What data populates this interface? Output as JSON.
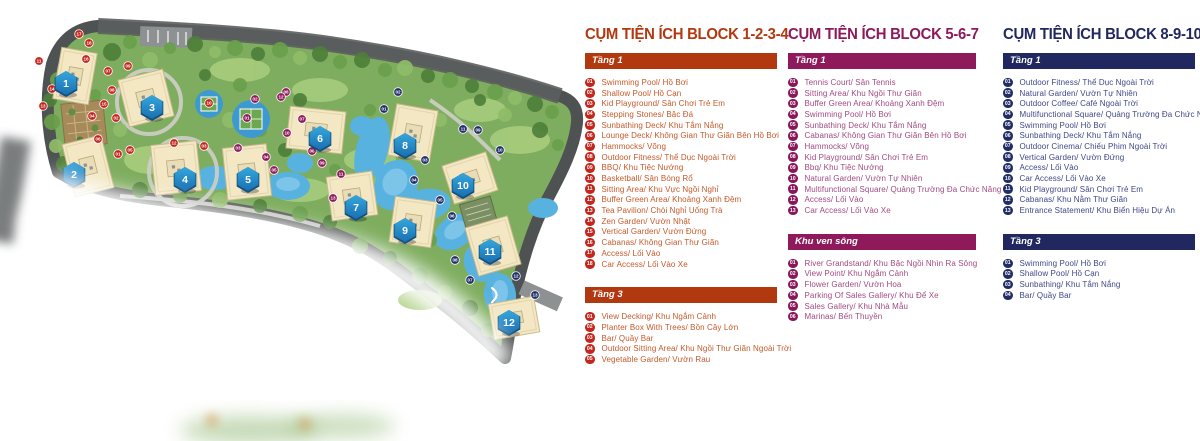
{
  "map": {
    "colors": {
      "site_green": "#7FAD5F",
      "tree_dark": "#4E7F3A",
      "tree_mid": "#69A04B",
      "tree_light": "#8FBC68",
      "lawn": "#A9CE7E",
      "road": "#4F5252",
      "path": "#CFCFC8",
      "water": "#58B2DF",
      "water_light": "#9AD4F0",
      "building": "#F3E7C4",
      "building_edge": "#C9B88C",
      "marker_blue_top": "#35A7DD",
      "marker_blue_bottom": "#1A6FB0",
      "marker_blue_edge": "#10507F"
    },
    "buildings": [
      {
        "num": "1",
        "marker": {
          "x": 66,
          "y": 84
        },
        "rect": {
          "cx": 75,
          "cy": 76,
          "w": 36,
          "h": 52,
          "rot": 10
        }
      },
      {
        "num": "2",
        "marker": {
          "x": 74,
          "y": 175
        },
        "rect": {
          "cx": 88,
          "cy": 166,
          "w": 40,
          "h": 54,
          "rot": -14
        }
      },
      {
        "num": "3",
        "marker": {
          "x": 152,
          "y": 108
        },
        "rect": {
          "cx": 146,
          "cy": 98,
          "w": 46,
          "h": 48,
          "rot": -14
        }
      },
      {
        "num": "4",
        "marker": {
          "x": 185,
          "y": 180
        },
        "rect": {
          "cx": 176,
          "cy": 168,
          "w": 46,
          "h": 50,
          "rot": -6
        }
      },
      {
        "num": "5",
        "marker": {
          "x": 248,
          "y": 180
        },
        "rect": {
          "cx": 247,
          "cy": 172,
          "w": 44,
          "h": 52,
          "rot": -6
        }
      },
      {
        "num": "6",
        "marker": {
          "x": 320,
          "y": 139
        },
        "rect": {
          "cx": 316,
          "cy": 130,
          "w": 56,
          "h": 42,
          "rot": 6
        }
      },
      {
        "num": "7",
        "marker": {
          "x": 356,
          "y": 208
        },
        "rect": {
          "cx": 352,
          "cy": 196,
          "w": 46,
          "h": 44,
          "rot": -8
        }
      },
      {
        "num": "8",
        "marker": {
          "x": 405,
          "y": 146
        },
        "rect": {
          "cx": 413,
          "cy": 133,
          "w": 42,
          "h": 52,
          "rot": 10
        }
      },
      {
        "num": "9",
        "marker": {
          "x": 405,
          "y": 231
        },
        "rect": {
          "cx": 413,
          "cy": 222,
          "w": 42,
          "h": 46,
          "rot": 8
        }
      },
      {
        "num": "10",
        "marker": {
          "x": 463,
          "y": 186
        },
        "rect": {
          "cx": 470,
          "cy": 178,
          "w": 46,
          "h": 40,
          "rot": -18
        }
      },
      {
        "num": "11",
        "marker": {
          "x": 490,
          "y": 252
        },
        "rect": {
          "cx": 493,
          "cy": 246,
          "w": 44,
          "h": 50,
          "rot": -16
        }
      },
      {
        "num": "12",
        "marker": {
          "x": 509,
          "y": 323
        },
        "rect": {
          "cx": 514,
          "cy": 318,
          "w": 46,
          "h": 36,
          "rot": -10
        }
      }
    ],
    "amenity_dots": [
      {
        "group": "red",
        "color": "#C2261C",
        "dots": [
          {
            "n": "01",
            "x": 118,
            "y": 154
          },
          {
            "n": "02",
            "x": 116,
            "y": 118
          },
          {
            "n": "03",
            "x": 204,
            "y": 146
          },
          {
            "n": "04",
            "x": 92,
            "y": 116
          },
          {
            "n": "05",
            "x": 130,
            "y": 150
          },
          {
            "n": "06",
            "x": 98,
            "y": 139
          },
          {
            "n": "07",
            "x": 108,
            "y": 71
          },
          {
            "n": "08",
            "x": 112,
            "y": 90
          },
          {
            "n": "09",
            "x": 128,
            "y": 66
          },
          {
            "n": "10",
            "x": 209,
            "y": 103
          },
          {
            "n": "11",
            "x": 39,
            "y": 61
          },
          {
            "n": "12",
            "x": 174,
            "y": 143
          },
          {
            "n": "13",
            "x": 43,
            "y": 106
          },
          {
            "n": "14",
            "x": 52,
            "y": 89
          },
          {
            "n": "15",
            "x": 104,
            "y": 104
          },
          {
            "n": "16",
            "x": 86,
            "y": 59
          },
          {
            "n": "17",
            "x": 79,
            "y": 34
          },
          {
            "n": "18",
            "x": 89,
            "y": 43
          }
        ]
      },
      {
        "group": "purple",
        "color": "#8E1A5B",
        "dots": [
          {
            "n": "01",
            "x": 247,
            "y": 118
          },
          {
            "n": "02",
            "x": 255,
            "y": 99
          },
          {
            "n": "03",
            "x": 238,
            "y": 148
          },
          {
            "n": "04",
            "x": 266,
            "y": 157
          },
          {
            "n": "05",
            "x": 274,
            "y": 170
          },
          {
            "n": "06",
            "x": 286,
            "y": 92
          },
          {
            "n": "07",
            "x": 302,
            "y": 119
          },
          {
            "n": "08",
            "x": 312,
            "y": 151
          },
          {
            "n": "09",
            "x": 322,
            "y": 163
          },
          {
            "n": "10",
            "x": 287,
            "y": 133
          },
          {
            "n": "11",
            "x": 341,
            "y": 174
          },
          {
            "n": "12",
            "x": 281,
            "y": 97
          },
          {
            "n": "13",
            "x": 333,
            "y": 198
          }
        ]
      },
      {
        "group": "navy",
        "color": "#202D66",
        "dots": [
          {
            "n": "01",
            "x": 384,
            "y": 109
          },
          {
            "n": "02",
            "x": 398,
            "y": 92
          },
          {
            "n": "03",
            "x": 425,
            "y": 160
          },
          {
            "n": "04",
            "x": 414,
            "y": 180
          },
          {
            "n": "05",
            "x": 440,
            "y": 200
          },
          {
            "n": "06",
            "x": 452,
            "y": 216
          },
          {
            "n": "07",
            "x": 470,
            "y": 280
          },
          {
            "n": "08",
            "x": 455,
            "y": 260
          },
          {
            "n": "09",
            "x": 478,
            "y": 130
          },
          {
            "n": "10",
            "x": 500,
            "y": 150
          },
          {
            "n": "11",
            "x": 463,
            "y": 129
          },
          {
            "n": "12",
            "x": 516,
            "y": 276
          },
          {
            "n": "13",
            "x": 535,
            "y": 295
          }
        ]
      }
    ]
  },
  "legend": {
    "columns": [
      {
        "id": "block-1-2-3-4",
        "title": "CỤM TIỆN ÍCH BLOCK 1-2-3-4",
        "accent": "#B2390F",
        "badge": "#C2261C",
        "text": "#C45A2B",
        "left": 585,
        "width": 192,
        "sections": [
          {
            "heading": "Tầng 1",
            "items": [
              {
                "num": "01",
                "label": "Swimming Pool/ Hồ Bơi"
              },
              {
                "num": "02",
                "label": "Shallow Pool/ Hồ Cạn"
              },
              {
                "num": "03",
                "label": "Kid Playground/ Sân Chơi Trẻ Em"
              },
              {
                "num": "04",
                "label": "Stepping Stones/ Bậc Đá"
              },
              {
                "num": "05",
                "label": "Sunbathing Deck/ Khu Tắm Nắng"
              },
              {
                "num": "06",
                "label": "Lounge Deck/ Không Gian Thư Giãn Bên Hồ Bơi"
              },
              {
                "num": "07",
                "label": "Hammocks/ Võng"
              },
              {
                "num": "08",
                "label": "Outdoor Fitness/ Thể Dục Ngoài Trời"
              },
              {
                "num": "09",
                "label": "BBQ/ Khu Tiệc Nướng"
              },
              {
                "num": "10",
                "label": "Basketball/ Sân Bóng Rổ"
              },
              {
                "num": "11",
                "label": "Sitting Area/ Khu Vực Ngồi Nghỉ"
              },
              {
                "num": "12",
                "label": "Buffer Green Area/ Khoảng Xanh Đệm"
              },
              {
                "num": "13",
                "label": "Tea Pavilion/ Chòi Nghỉ Uống Trà"
              },
              {
                "num": "14",
                "label": "Zen Garden/ Vườn Nhật"
              },
              {
                "num": "15",
                "label": "Vertical Garden/ Vườn Đứng"
              },
              {
                "num": "16",
                "label": "Cabanas/ Không Gian Thư Giãn"
              },
              {
                "num": "17",
                "label": "Access/ Lối Vào"
              },
              {
                "num": "18",
                "label": "Car Access/ Lối Vào Xe"
              }
            ]
          },
          {
            "heading": "Tầng 3",
            "items": [
              {
                "num": "01",
                "label": "View Decking/ Khu Ngắm Cảnh"
              },
              {
                "num": "02",
                "label": "Planter Box With Trees/ Bồn Cây Lớn"
              },
              {
                "num": "03",
                "label": "Bar/ Quầy Bar"
              },
              {
                "num": "04",
                "label": "Outdoor Sitting Area/ Khu Ngồi Thư Giãn Ngoài Trời"
              },
              {
                "num": "05",
                "label": "Vegetable Garden/ Vườn Rau"
              }
            ]
          }
        ]
      },
      {
        "id": "block-5-6-7",
        "title": "CỤM TIỆN ÍCH BLOCK 5-6-7",
        "accent": "#8E1A5B",
        "badge": "#87175A",
        "text": "#A14B82",
        "left": 788,
        "width": 188,
        "sections": [
          {
            "heading": "Tầng 1",
            "items": [
              {
                "num": "01",
                "label": "Tennis Court/ Sân Tennis"
              },
              {
                "num": "02",
                "label": "Sitting Area/ Khu Ngồi Thư Giãn"
              },
              {
                "num": "03",
                "label": "Buffer Green Area/ Khoảng Xanh Đệm"
              },
              {
                "num": "04",
                "label": "Swimming Pool/ Hồ Bơi"
              },
              {
                "num": "05",
                "label": "Sunbathing Deck/ Khu Tắm Nắng"
              },
              {
                "num": "06",
                "label": "Cabanas/ Không Gian Thư Giãn Bên Hồ Bơi"
              },
              {
                "num": "07",
                "label": "Hammocks/ Võng"
              },
              {
                "num": "08",
                "label": "Kid Playground/ Sân Chơi Trẻ Em"
              },
              {
                "num": "09",
                "label": "Bbq/ Khu Tiệc Nướng"
              },
              {
                "num": "10",
                "label": "Natural Garden/ Vườn Tự Nhiên"
              },
              {
                "num": "11",
                "label": "Multifunctional Square/ Quảng Trường Đa Chức Năng"
              },
              {
                "num": "12",
                "label": "Access/ Lối Vào"
              },
              {
                "num": "13",
                "label": "Car Access/ Lối Vào Xe"
              }
            ]
          },
          {
            "heading": "Khu ven sông",
            "items": [
              {
                "num": "01",
                "label": "River Grandstand/ Khu Bậc Ngồi Nhìn Ra Sông"
              },
              {
                "num": "02",
                "label": "View Point/ Khu Ngắm Cảnh"
              },
              {
                "num": "03",
                "label": "Flower Garden/ Vườn Hoa"
              },
              {
                "num": "04",
                "label": "Parking Of Sales Gallery/ Khu Để Xe"
              },
              {
                "num": "05",
                "label": "Sales Gallery/ Khu Nhà Mẫu"
              },
              {
                "num": "06",
                "label": "Marinas/ Bến Thuyền"
              }
            ]
          }
        ]
      },
      {
        "id": "block-8-9-10-11-12",
        "title": "CỤM TIỆN ÍCH BLOCK 8-9-10-11-12",
        "accent": "#20285F",
        "badge": "#202D66",
        "text": "#3E4886",
        "left": 1003,
        "width": 192,
        "sections": [
          {
            "heading": "Tầng 1",
            "items": [
              {
                "num": "01",
                "label": "Outdoor Fitness/ Thể Dục Ngoài Trời"
              },
              {
                "num": "02",
                "label": "Natural Garden/ Vườn Tự Nhiên"
              },
              {
                "num": "03",
                "label": "Outdoor Coffee/ Café Ngoài Trời"
              },
              {
                "num": "04",
                "label": "Multifunctional Square/ Quảng Trường Đa Chức Năng"
              },
              {
                "num": "05",
                "label": "Swimming Pool/ Hồ Bơi"
              },
              {
                "num": "06",
                "label": "Sunbathing Deck/ Khu Tắm Nắng"
              },
              {
                "num": "07",
                "label": "Outdoor Cinema/ Chiếu Phim Ngoài Trời"
              },
              {
                "num": "08",
                "label": "Vertical Garden/ Vườn Đứng"
              },
              {
                "num": "09",
                "label": "Access/ Lối Vào"
              },
              {
                "num": "10",
                "label": "Car Access/ Lối Vào Xe"
              },
              {
                "num": "11",
                "label": "Kid Playground/ Sân Chơi Trẻ Em"
              },
              {
                "num": "12",
                "label": "Cabanas/ Khu Nằm Thư Giãn"
              },
              {
                "num": "13",
                "label": "Entrance Statement/ Khu Biển Hiệu Dự Án"
              }
            ]
          },
          {
            "heading": "Tầng 3",
            "items": [
              {
                "num": "01",
                "label": "Swimming Pool/ Hồ Bơi"
              },
              {
                "num": "02",
                "label": "Shallow Pool/ Hồ Cạn"
              },
              {
                "num": "03",
                "label": "Sunbathing/ Khu Tắm Nắng"
              },
              {
                "num": "04",
                "label": "Bar/ Quầy Bar"
              }
            ]
          }
        ]
      }
    ]
  }
}
